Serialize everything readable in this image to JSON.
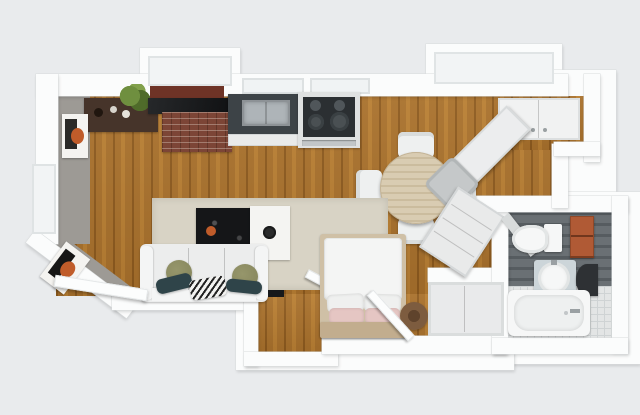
{
  "scene": {
    "type": "3d-floor-plan-top-view",
    "description": "Rendered top-down 3D floor plan of a studio apartment with open living/kitchen area, sleeping nook and bathroom",
    "rooms": [
      {
        "name": "kitchen",
        "floor": "wood",
        "position": "top"
      },
      {
        "name": "living-area",
        "floor": "wood-with-rug",
        "position": "left-center"
      },
      {
        "name": "dining-area",
        "floor": "wood",
        "position": "center-right"
      },
      {
        "name": "sleeping-nook",
        "floor": "wood",
        "position": "bottom-center"
      },
      {
        "name": "entry-nook",
        "floor": "wood",
        "position": "bottom-left-center"
      },
      {
        "name": "closet-alcove",
        "floor": "wood",
        "position": "top-right"
      },
      {
        "name": "bathroom",
        "floor": "dark-plank-and-white-tile",
        "position": "right-bottom-wing"
      }
    ],
    "furniture": [
      "sideboard",
      "potted-plant",
      "brick-chimney",
      "dark-countertop",
      "kitchen-sink-counter",
      "base-cabinets",
      "stove-with-cooktop",
      "round-dining-table",
      "dining-chair-north",
      "dining-chair-south",
      "dining-chair-west",
      "dining-chair-east",
      "desk",
      "desk-chair",
      "closet-double-doors",
      "area-rug",
      "black-coffee-table",
      "white-nesting-table",
      "three-seat-sofa",
      "olive-throw-pillows",
      "teal-lumbar-pillows",
      "striped-pillow",
      "wall-art-top-left",
      "wall-art-entry",
      "entry-door",
      "niche-door",
      "double-bed",
      "pink-pillows",
      "drum-side-table",
      "angled-dresser",
      "built-in-closet",
      "closet-door",
      "bathroom-door",
      "toilet",
      "terracotta-shelf",
      "pedestal-sink",
      "dark-wall-mirror",
      "bathtub"
    ]
  },
  "colors": {
    "background": "#e9ebed",
    "wall": "#fbfcfc",
    "wall_shade": "#d9dcdd",
    "gray_wall": "#9d9a95",
    "floor_wood_light": "#b97f33",
    "floor_wood_mid": "#a9712c",
    "floor_wood_dark": "#8d5a1e",
    "rug": "#d8d3c5",
    "sofa": "#eceded",
    "sofa_light": "#f4f5f5",
    "pillow_olive": "#85855c",
    "pillow_teal": "#2f4449",
    "table_black": "#151618",
    "table_white": "#f4f4f2",
    "sideboard": "#46342a",
    "brick": "#7c4536",
    "backsplash": "#6e3326",
    "counter_dark": "#3d4347",
    "steel": "#aeb4b8",
    "cabinet_white": "#e9eaea",
    "cooktop": "#2b2f32",
    "dining_wood": "#d9ccb2",
    "chair_white": "#eef0f0",
    "desk_gray": "#c5c8c9",
    "bed_frame": "#cfc0a6",
    "headboard": "#c2ad8e",
    "duvet": "#f4f5f4",
    "pillow_pink": "#e5c6c3",
    "drum": "#7d5c3f",
    "drum_dark": "#5f432c",
    "bath_floor_dark": "#6a7074",
    "bath_floor_darker": "#565c60",
    "tile": "#e3e5e5",
    "tile_line": "#cfd3d4",
    "terracotta": "#b05a35",
    "porcelain": "#f6f7f7",
    "mirror_dark": "#2e3134",
    "vanity_blue": "#ccd5d9",
    "plant": "#6f8f3f",
    "plant_dark": "#4f6b2a",
    "art_orange": "#c05c2a",
    "art_dark": "#2a2a28",
    "door_white": "#fcfdfd"
  }
}
